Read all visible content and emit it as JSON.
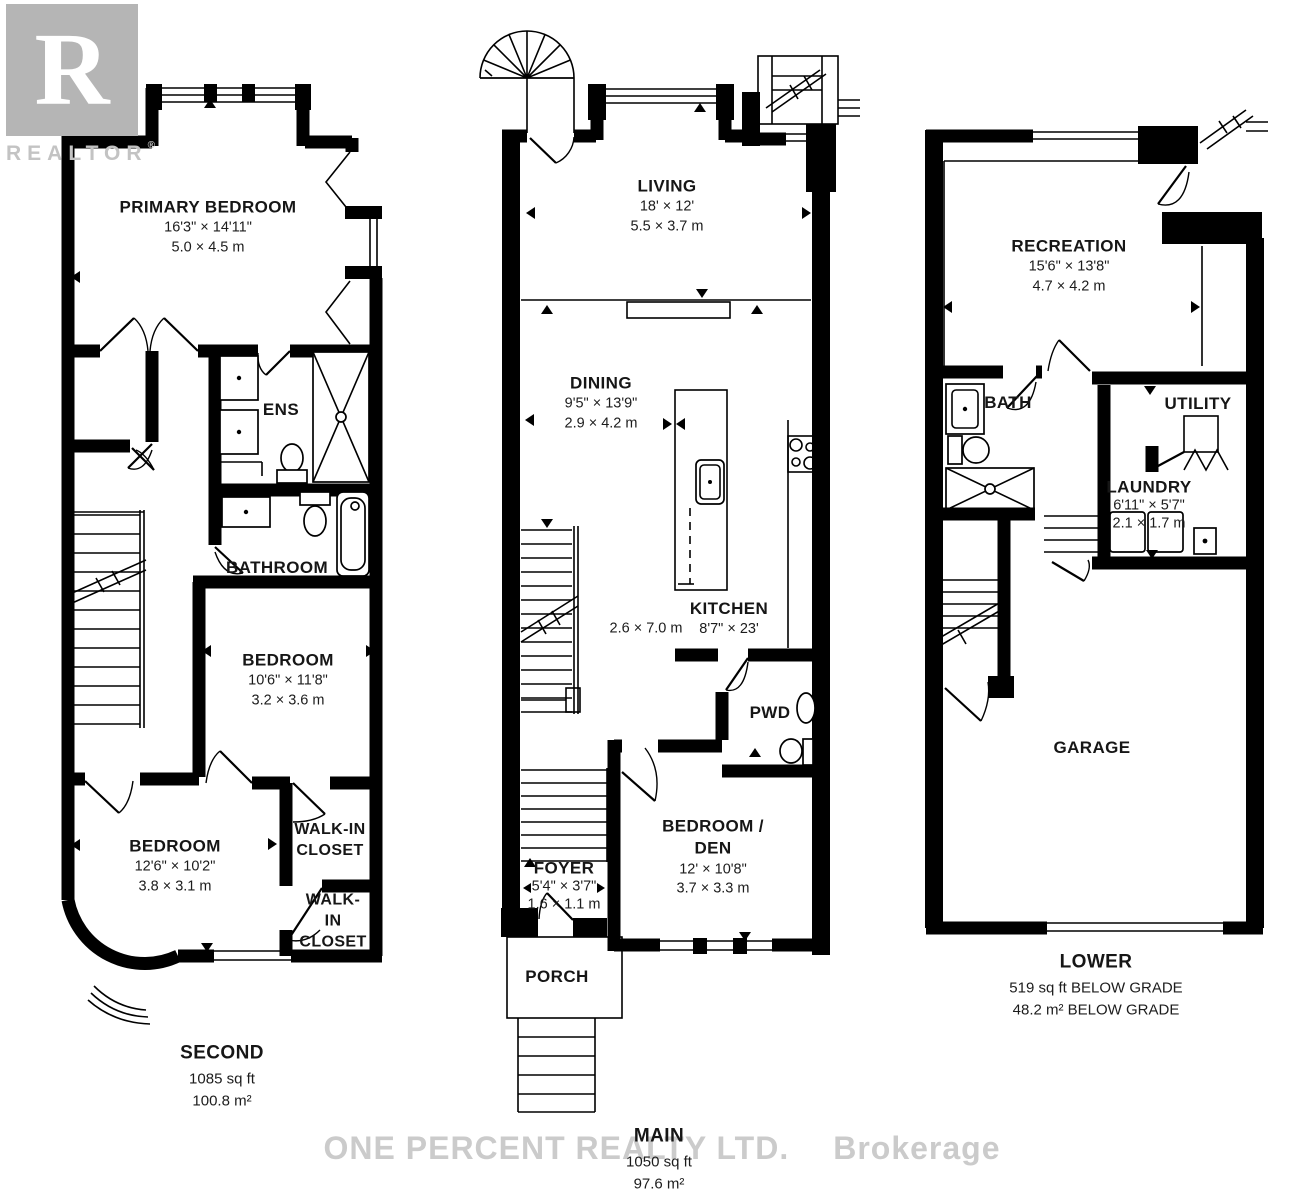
{
  "watermarks": {
    "realtor_letter": "R",
    "realtor_text": "REALTOR",
    "registered_mark": "®",
    "brokerage_name": "ONE PERCENT REALTY LTD.",
    "brokerage_suffix": "Brokerage"
  },
  "floors": [
    {
      "id": "second",
      "label": "SECOND",
      "area_imperial": "1085 sq ft",
      "area_metric": "100.8 m²",
      "rooms": [
        {
          "name": "PRIMARY BEDROOM",
          "dims": "16'3\" × 14'11\"",
          "metric": "5.0 × 4.5 m"
        },
        {
          "name": "ENS"
        },
        {
          "name": "BATHROOM"
        },
        {
          "name": "BEDROOM",
          "dims": "10'6\" × 11'8\"",
          "metric": "3.2 × 3.6 m"
        },
        {
          "name": "WALK-IN CLOSET"
        },
        {
          "name": "WALK-IN CLOSET"
        },
        {
          "name": "BEDROOM",
          "dims": "12'6\" × 10'2\"",
          "metric": "3.8 × 3.1 m"
        }
      ]
    },
    {
      "id": "main",
      "label": "MAIN",
      "area_imperial": "1050 sq ft",
      "area_metric": "97.6 m²",
      "rooms": [
        {
          "name": "LIVING",
          "dims": "18' × 12'",
          "metric": "5.5 × 3.7 m"
        },
        {
          "name": "DINING",
          "dims": "9'5\" × 13'9\"",
          "metric": "2.9 × 4.2 m"
        },
        {
          "name": "KITCHEN",
          "dims": "8'7\" × 23'",
          "metric": "2.6 × 7.0 m"
        },
        {
          "name": "PWD"
        },
        {
          "name": "BEDROOM / DEN",
          "dims": "12' × 10'8\"",
          "metric": "3.7 × 3.3 m"
        },
        {
          "name": "FOYER",
          "dims": "5'4\" × 3'7\"",
          "metric": "1.6 × 1.1 m"
        },
        {
          "name": "PORCH"
        }
      ]
    },
    {
      "id": "lower",
      "label": "LOWER",
      "area_imperial": "519 sq ft BELOW GRADE",
      "area_metric": "48.2 m² BELOW GRADE",
      "rooms": [
        {
          "name": "RECREATION",
          "dims": "15'6\" × 13'8\"",
          "metric": "4.7 × 4.2 m"
        },
        {
          "name": "BATH"
        },
        {
          "name": "UTILITY"
        },
        {
          "name": "LAUNDRY",
          "dims": "6'11\" × 5'7\"",
          "metric": "2.1 × 1.7 m"
        },
        {
          "name": "GARAGE"
        }
      ]
    }
  ]
}
